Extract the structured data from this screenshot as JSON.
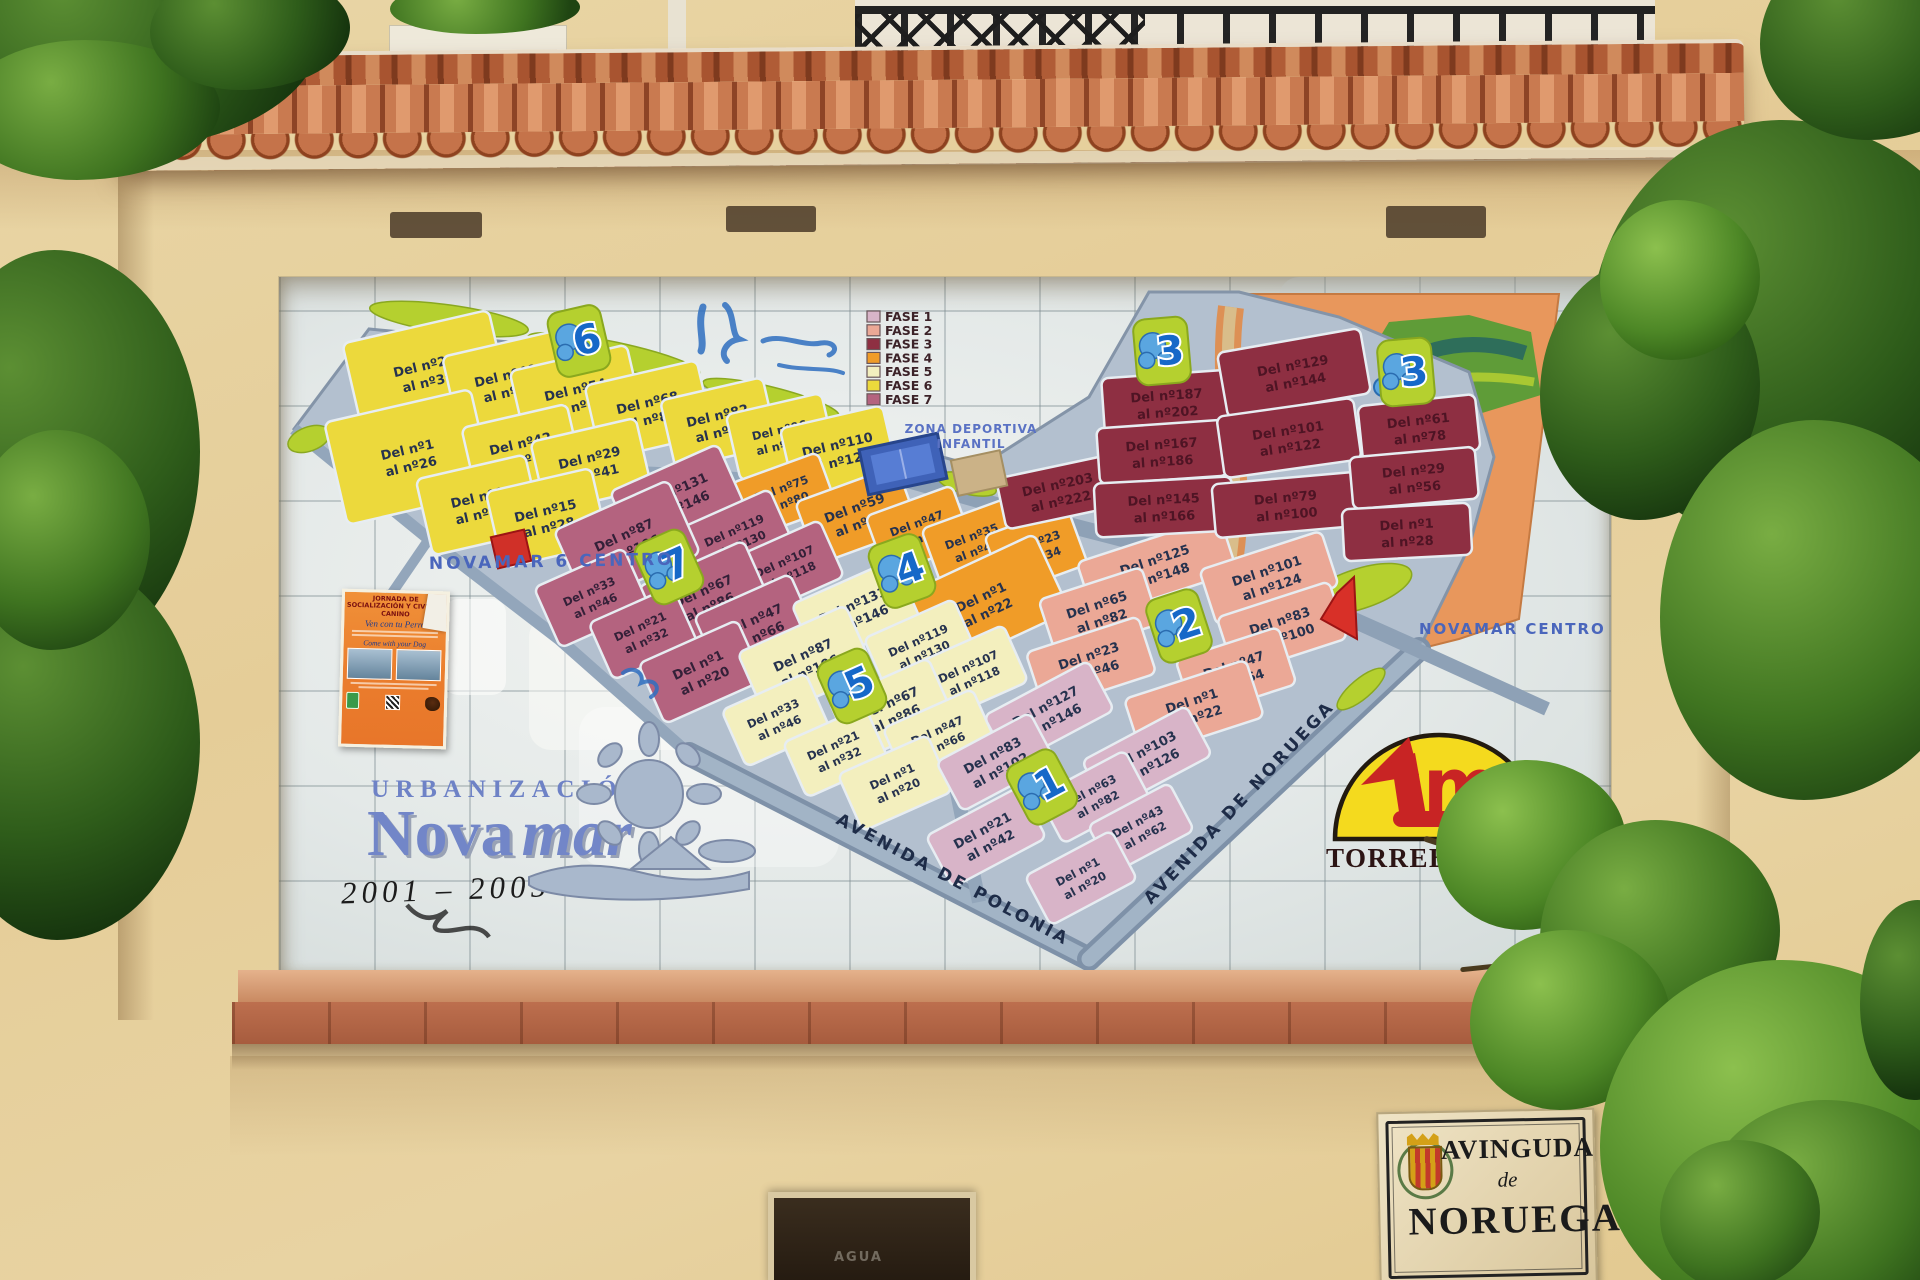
{
  "legend": {
    "items": [
      {
        "label": "FASE 1",
        "color": "#d8b4c8"
      },
      {
        "label": "FASE 2",
        "color": "#eba896"
      },
      {
        "label": "FASE 3",
        "color": "#8e2f42"
      },
      {
        "label": "FASE 4",
        "color": "#f09c28"
      },
      {
        "label": "FASE 5",
        "color": "#f3efbe"
      },
      {
        "label": "FASE 6",
        "color": "#ecd93c"
      },
      {
        "label": "FASE 7",
        "color": "#b4637f"
      }
    ]
  },
  "map": {
    "area_labels": {
      "novamar6_centro": "NOVAMAR 6 CENTRO",
      "novamar_centro": "NOVAMAR CENTRO",
      "zona_deportiva_line1": "ZONA DEPORTIVA",
      "zona_deportiva_line2": "INFANTIL"
    },
    "streets": {
      "polonia": "AVENIDA DE POLONIA",
      "noruega": "AVENIDA DE NORUEGA"
    },
    "markers": [
      {
        "n": "6",
        "x": 300,
        "y": 64,
        "r": -13
      },
      {
        "n": "4",
        "x": 623,
        "y": 294,
        "r": -20
      },
      {
        "n": "7",
        "x": 390,
        "y": 290,
        "r": -24
      },
      {
        "n": "5",
        "x": 573,
        "y": 409,
        "r": -24
      },
      {
        "n": "2",
        "x": 900,
        "y": 349,
        "r": -18
      },
      {
        "n": "1",
        "x": 763,
        "y": 510,
        "r": -28
      },
      {
        "n": "3",
        "x": 883,
        "y": 74,
        "r": -5
      },
      {
        "n": "3",
        "x": 1127,
        "y": 95,
        "r": -5
      }
    ],
    "phases": [
      {
        "name": "FASE 6",
        "color": "#ecd93c",
        "text": "#26324e",
        "rot": -13,
        "plots": [
          {
            "l": "Del nº27 al nº39",
            "x": 147,
            "y": 96,
            "w": 150,
            "h": 95
          },
          {
            "l": "Del nº40 al nº53",
            "x": 228,
            "y": 106,
            "w": 115,
            "h": 80
          },
          {
            "l": "Del nº54 al nº67",
            "x": 298,
            "y": 120,
            "w": 120,
            "h": 80
          },
          {
            "l": "Del nº68 al nº81",
            "x": 370,
            "y": 133,
            "w": 115,
            "h": 76
          },
          {
            "l": "Del nº82 al nº95",
            "x": 440,
            "y": 146,
            "w": 105,
            "h": 70
          },
          {
            "l": "Del nº96 al nº109",
            "x": 502,
            "y": 160,
            "w": 98,
            "h": 68
          },
          {
            "l": "Del nº110 al nº123",
            "x": 560,
            "y": 175,
            "w": 105,
            "h": 72
          },
          {
            "l": "Del nº1 al nº26",
            "x": 130,
            "y": 180,
            "w": 150,
            "h": 105
          },
          {
            "l": "Del nº42 al nº54",
            "x": 243,
            "y": 174,
            "w": 108,
            "h": 72
          },
          {
            "l": "Del nº29 al nº41",
            "x": 312,
            "y": 188,
            "w": 108,
            "h": 72
          },
          {
            "l": "Del nº1 al nº14",
            "x": 200,
            "y": 228,
            "w": 112,
            "h": 78
          },
          {
            "l": "Del nº15 al nº28",
            "x": 268,
            "y": 241,
            "w": 108,
            "h": 78
          }
        ]
      },
      {
        "name": "FASE 4",
        "color": "#f09c28",
        "text": "#26324e",
        "rot": -20,
        "plots": [
          {
            "l": "Del nº75 al nº80",
            "x": 505,
            "y": 218,
            "w": 92,
            "h": 58
          },
          {
            "l": "Del nº59 al nº74",
            "x": 578,
            "y": 238,
            "w": 108,
            "h": 66
          },
          {
            "l": "Del nº47 al nº58",
            "x": 640,
            "y": 253,
            "w": 92,
            "h": 62
          },
          {
            "l": "Del nº35 al nº46",
            "x": 695,
            "y": 266,
            "w": 90,
            "h": 62
          },
          {
            "l": "Del nº23 al nº34",
            "x": 757,
            "y": 273,
            "w": 88,
            "h": 62
          },
          {
            "l": "Del nº1 al nº22",
            "x": 705,
            "y": 327,
            "w": 150,
            "h": 85,
            "r": -25
          }
        ]
      },
      {
        "name": "FASE 7",
        "color": "#b4637f",
        "text": "#342038",
        "rot": -24,
        "plots": [
          {
            "l": "Del nº131 al nº146",
            "x": 398,
            "y": 221,
            "w": 118,
            "h": 66
          },
          {
            "l": "Del nº119 al nº130",
            "x": 458,
            "y": 260,
            "w": 98,
            "h": 62
          },
          {
            "l": "Del nº107 al nº118",
            "x": 508,
            "y": 291,
            "w": 98,
            "h": 62
          },
          {
            "l": "Del nº87 al nº106",
            "x": 348,
            "y": 265,
            "w": 125,
            "h": 80
          },
          {
            "l": "Del nº67 al nº86",
            "x": 427,
            "y": 321,
            "w": 115,
            "h": 75
          },
          {
            "l": "Del nº47 al nº66",
            "x": 477,
            "y": 350,
            "w": 105,
            "h": 70
          },
          {
            "l": "Del nº33 al nº46",
            "x": 313,
            "y": 321,
            "w": 98,
            "h": 66
          },
          {
            "l": "Del nº21 al nº32",
            "x": 364,
            "y": 356,
            "w": 92,
            "h": 62
          },
          {
            "l": "Del nº1 al nº20",
            "x": 422,
            "y": 395,
            "w": 108,
            "h": 66
          }
        ]
      },
      {
        "name": "FASE 5",
        "color": "#f3efbe",
        "text": "#26324e",
        "rot": -24,
        "plots": [
          {
            "l": "Del nº131 al nº146",
            "x": 577,
            "y": 335,
            "w": 112,
            "h": 66
          },
          {
            "l": "Del nº119 al nº130",
            "x": 642,
            "y": 370,
            "w": 98,
            "h": 62
          },
          {
            "l": "Del nº107 al nº118",
            "x": 692,
            "y": 396,
            "w": 98,
            "h": 62
          },
          {
            "l": "Del nº87 al nº106",
            "x": 527,
            "y": 385,
            "w": 118,
            "h": 72
          },
          {
            "l": "Del nº67 al nº86",
            "x": 613,
            "y": 433,
            "w": 108,
            "h": 66
          },
          {
            "l": "Del nº47 al nº66",
            "x": 661,
            "y": 460,
            "w": 98,
            "h": 62
          },
          {
            "l": "Del nº33 al nº46",
            "x": 497,
            "y": 443,
            "w": 92,
            "h": 62
          },
          {
            "l": "Del nº21 al nº32",
            "x": 557,
            "y": 475,
            "w": 90,
            "h": 60
          },
          {
            "l": "Del nº1 al nº20",
            "x": 616,
            "y": 506,
            "w": 98,
            "h": 62
          }
        ]
      },
      {
        "name": "FASE 2",
        "color": "#eba896",
        "text": "#26324e",
        "rot": -18,
        "plots": [
          {
            "l": "Del nº125 al nº148",
            "x": 878,
            "y": 290,
            "w": 150,
            "h": 58
          },
          {
            "l": "Del nº101 al nº124",
            "x": 990,
            "y": 301,
            "w": 128,
            "h": 58
          },
          {
            "l": "Del nº65 al nº82",
            "x": 820,
            "y": 335,
            "w": 108,
            "h": 60
          },
          {
            "l": "Del nº83 al nº100",
            "x": 1003,
            "y": 351,
            "w": 118,
            "h": 60
          },
          {
            "l": "Del nº23 al nº46",
            "x": 812,
            "y": 386,
            "w": 118,
            "h": 60
          },
          {
            "l": "Del nº47 al nº64",
            "x": 957,
            "y": 395,
            "w": 108,
            "h": 60
          },
          {
            "l": "Del nº1 al nº22",
            "x": 915,
            "y": 431,
            "w": 128,
            "h": 60
          }
        ]
      },
      {
        "name": "FASE 1",
        "color": "#d8b4c8",
        "text": "#26324e",
        "rot": -28,
        "plots": [
          {
            "l": "Del nº127 al nº146",
            "x": 770,
            "y": 436,
            "w": 118,
            "h": 56
          },
          {
            "l": "Del nº103 al nº126",
            "x": 868,
            "y": 481,
            "w": 118,
            "h": 56
          },
          {
            "l": "Del nº83 al nº102",
            "x": 717,
            "y": 485,
            "w": 106,
            "h": 56
          },
          {
            "l": "Del nº63 al nº82",
            "x": 815,
            "y": 520,
            "w": 98,
            "h": 54
          },
          {
            "l": "Del nº43 al nº62",
            "x": 862,
            "y": 551,
            "w": 92,
            "h": 54
          },
          {
            "l": "Del nº21 al nº42",
            "x": 707,
            "y": 560,
            "w": 106,
            "h": 58
          },
          {
            "l": "Del nº1 al nº20",
            "x": 802,
            "y": 601,
            "w": 98,
            "h": 56
          }
        ]
      },
      {
        "name": "FASE 3",
        "color": "#8e2f42",
        "text": "#4e1424",
        "rot": -5,
        "plots": [
          {
            "l": "Del nº203 al nº222",
            "x": 780,
            "y": 215,
            "w": 118,
            "h": 52,
            "r": -12
          },
          {
            "l": "Del nº187 al nº202",
            "x": 888,
            "y": 126,
            "w": 128,
            "h": 58,
            "r": -4
          },
          {
            "l": "Del nº167 al nº186",
            "x": 883,
            "y": 175,
            "w": 128,
            "h": 56,
            "r": -4
          },
          {
            "l": "Del nº145 al nº166",
            "x": 885,
            "y": 230,
            "w": 138,
            "h": 54,
            "r": -3
          },
          {
            "l": "Del nº129 al nº144",
            "x": 1015,
            "y": 96,
            "w": 145,
            "h": 66,
            "r": -10
          },
          {
            "l": "Del nº101 al nº122",
            "x": 1010,
            "y": 161,
            "w": 138,
            "h": 62,
            "r": -8
          },
          {
            "l": "Del nº79 al nº100",
            "x": 1007,
            "y": 228,
            "w": 145,
            "h": 54,
            "r": -5
          },
          {
            "l": "Del nº61 al nº78",
            "x": 1140,
            "y": 151,
            "w": 118,
            "h": 56,
            "r": -6
          },
          {
            "l": "Del nº29 al nº56",
            "x": 1135,
            "y": 201,
            "w": 126,
            "h": 52,
            "r": -5
          },
          {
            "l": "Del nº1 al nº28",
            "x": 1128,
            "y": 255,
            "w": 128,
            "h": 52,
            "r": -3
          }
        ]
      }
    ]
  },
  "title_block": {
    "urbanizacion": "URBANIZACIÓN",
    "name_roman": "Nova",
    "name_italic": "mar",
    "years": "2001 – 2005"
  },
  "logo": {
    "monogram": "m",
    "name": "TORREBLANCA"
  },
  "poster": {
    "headline": "JORNADA DE SOCIALIZACIÓN Y CIVISMO CANINO",
    "subtitle_es": "Ven con tu Perro",
    "subtitle_en": "Come with your Dog"
  },
  "street_sign": {
    "line1": "AVINGUDA",
    "line2": "de",
    "line3": "NORUEGA"
  },
  "wall_text": {
    "agua": "AGUA"
  }
}
